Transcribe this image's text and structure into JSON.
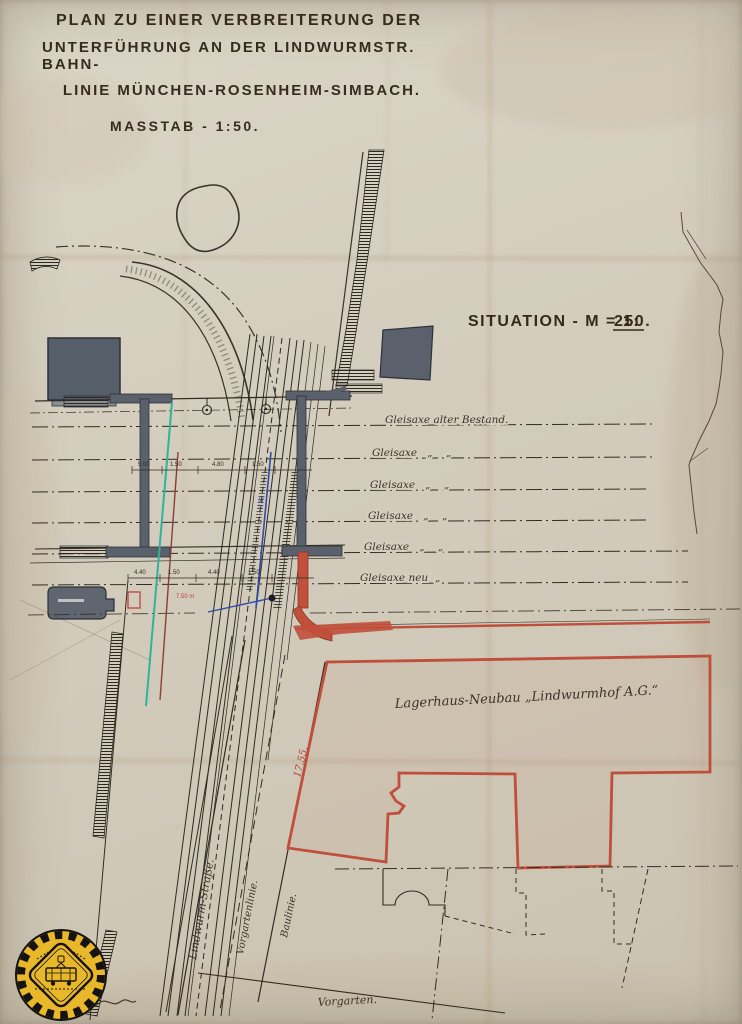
{
  "doc": {
    "title1": "PLAN ZU EINER VERBREITERUNG DER",
    "title2": "UNTERFÜHRUNG AN DER LINDWURMSTR. BAHN-",
    "title3": "LINIE MÜNCHEN-ROSENHEIM-SIMBACH.",
    "scale_label": "MASSTAB - 1:50.",
    "situation_prefix": "SITUATION - M = 1:",
    "situation_scale": "250."
  },
  "track_axes": {
    "items": [
      {
        "label": "Gleisaxe alter Bestand."
      },
      {
        "label": "Gleisaxe   „    „"
      },
      {
        "label": "Gleisaxe   „    „"
      },
      {
        "label": "Gleisaxe   „    „"
      },
      {
        "label": "Gleisaxe   „    „"
      },
      {
        "label": "Gleisaxe neu  „"
      }
    ]
  },
  "site": {
    "warehouse_label": "Lagerhaus-Neubau „Lindwurmhof A.G.“",
    "warehouse_dim": "17.55.",
    "street_label": "Lindwurm-Straße.",
    "front_garden_line_label": "Vorgartenlinie.",
    "building_line_label": "Baulinie.",
    "front_garden_label": "Vorgarten."
  },
  "dimensions": {
    "row1": [
      "5.00",
      "1.50",
      "4.80",
      "1.50"
    ],
    "row2": [
      "4.40",
      "1.50",
      "4.40",
      "1.50"
    ],
    "red_note": "7.50 m",
    "blue_note": "3.52"
  },
  "colors": {
    "ink": "#342c22",
    "red_accent": "#bf4f3c",
    "teal_accent": "#2fb39b",
    "blue_accent": "#2f4da8",
    "paper": "#d5cebf",
    "badge_yellow": "#e8b82a"
  }
}
